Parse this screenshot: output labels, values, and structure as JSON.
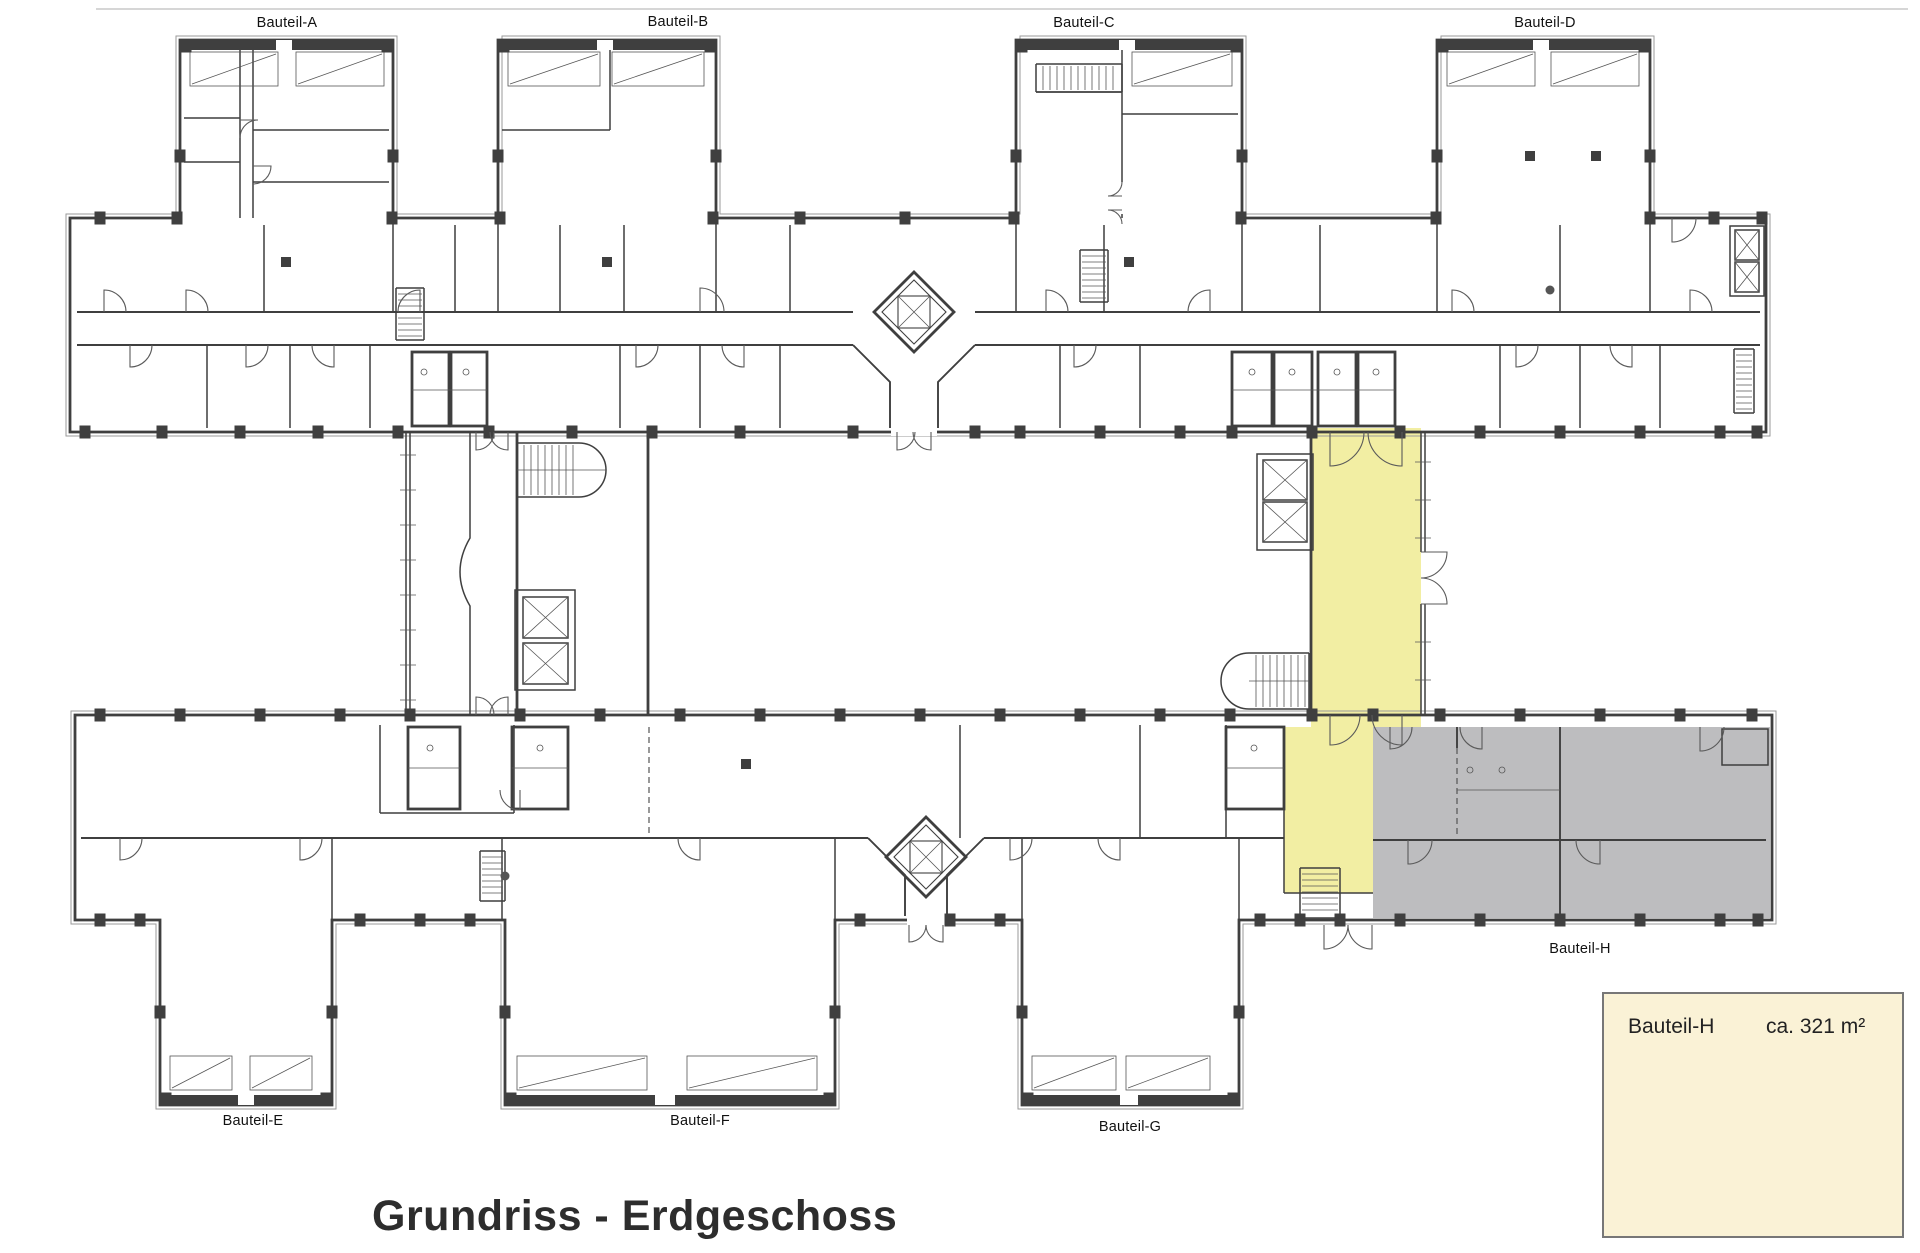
{
  "title": "Grundriss - Erdgeschoss",
  "labels": {
    "a": "Bauteil-A",
    "b": "Bauteil-B",
    "c": "Bauteil-C",
    "d": "Bauteil-D",
    "e": "Bauteil-E",
    "f": "Bauteil-F",
    "g": "Bauteil-G",
    "h": "Bauteil-H"
  },
  "legend": {
    "name": "Bauteil-H",
    "area": "ca. 321 m²"
  },
  "highlights": [
    {
      "key": "yellow",
      "meaning": "highlighted connector / entrance hall",
      "color": "#f2eea3"
    },
    {
      "key": "gray",
      "meaning": "Bauteil-H area",
      "color": "#bdbdbf"
    }
  ],
  "colors": {
    "yellow": "#f2eea3",
    "gray": "#bdbdbf",
    "legend_bg": "#faf2d6",
    "wall": "#3f3f3f",
    "wall_light": "#9a9a9a",
    "text": "#111111",
    "title": "#2d2d2d"
  }
}
